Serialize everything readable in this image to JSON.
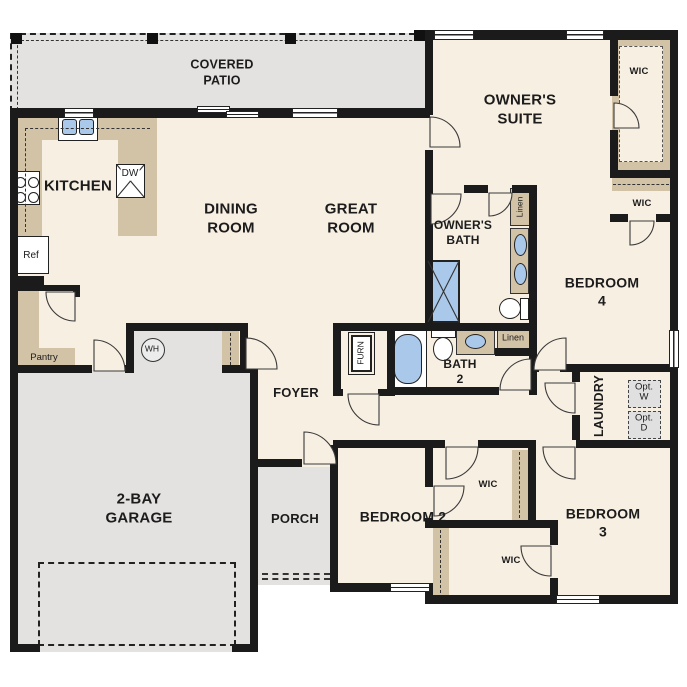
{
  "plan_type": "single-story floor plan",
  "labels": {
    "covered_patio": "COVERED\nPATIO",
    "kitchen": "KITCHEN",
    "dining_room": "DINING\nROOM",
    "great_room": "GREAT\nROOM",
    "owners_suite": "OWNER'S\nSUITE",
    "owners_bath": "OWNER'S\nBATH",
    "bedroom_4": "BEDROOM 4",
    "bedroom_2": "BEDROOM 2",
    "bedroom_3": "BEDROOM 3",
    "bath_2": "BATH\n2",
    "laundry": "LAUNDRY",
    "foyer": "FOYER",
    "porch": "PORCH",
    "garage": "2-BAY\nGARAGE",
    "wic_owners": "WIC",
    "wic_bedroom4": "WIC",
    "wic_bedroom2": "WIC",
    "wic_bedroom3": "WIC",
    "linen_owners": "Linen",
    "linen_hall": "Linen",
    "pantry": "Pantry",
    "refrigerator": "Ref",
    "dishwasher": "DW",
    "water_heater": "WH",
    "furnace": "FURN",
    "optional_washer": "Opt.\nW",
    "optional_dryer": "Opt.\nD"
  },
  "colors": {
    "wall": "#1b1b1b",
    "floor": "#f7efe2",
    "outdoor": "#e3e2e0",
    "counter": "#d2c2a6",
    "water": "#a9c8ea",
    "optional_box": "#e0e0e0"
  }
}
